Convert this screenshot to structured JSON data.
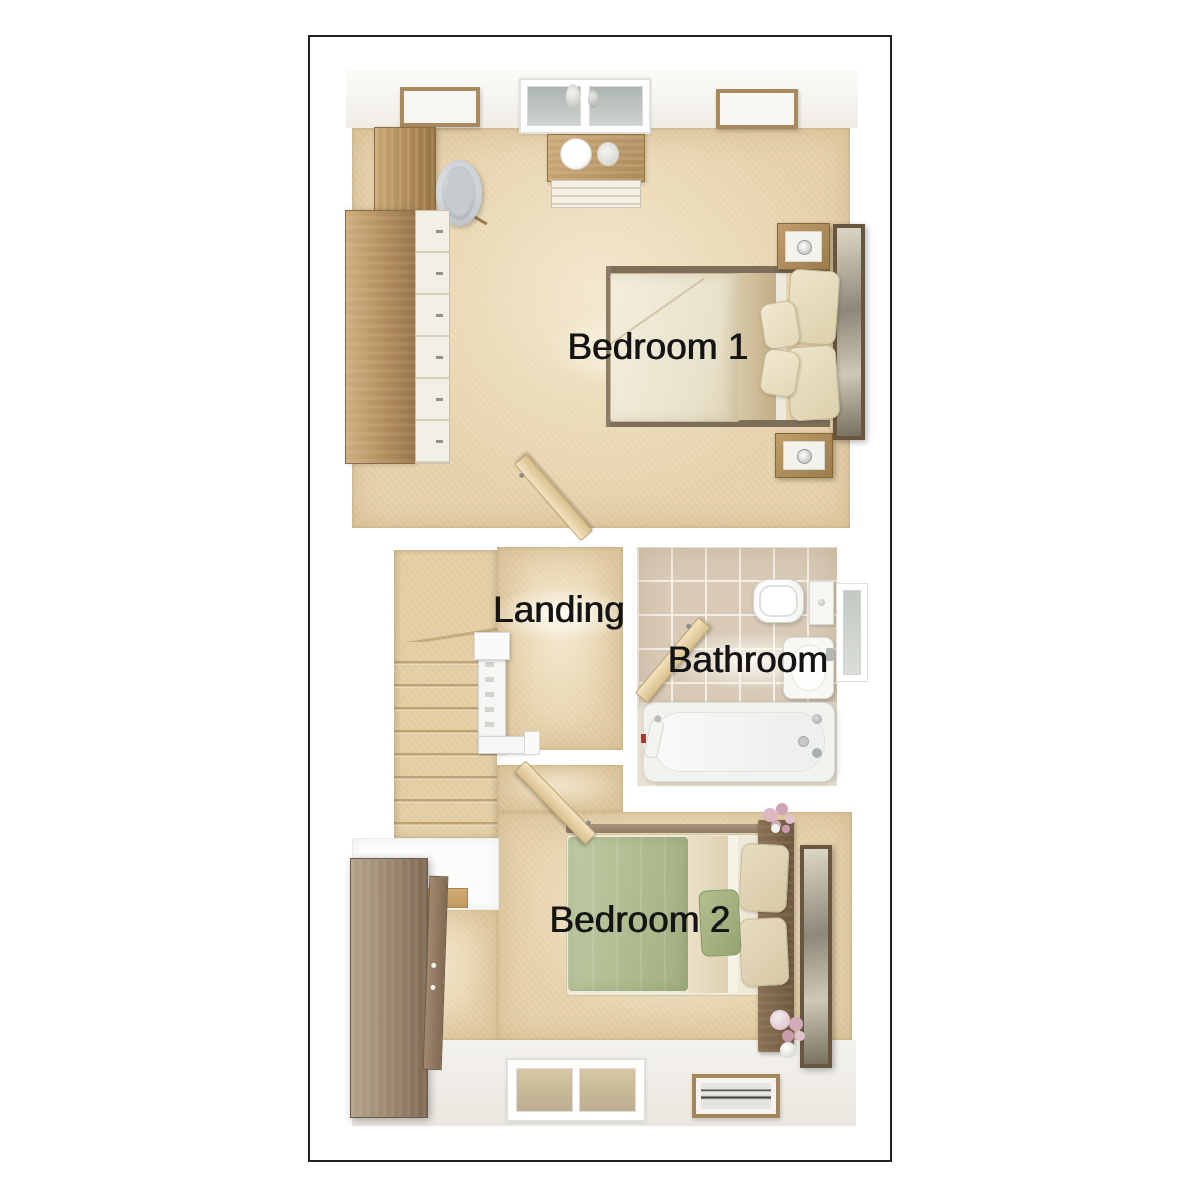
{
  "floorplan": {
    "rooms": [
      {
        "id": "bedroom-1",
        "label": "Bedroom 1",
        "furniture": [
          "double-bed",
          "pillows",
          "nightstand-with-lamp",
          "nightstand-with-lamp",
          "wall-mirror",
          "tall-wardrobe",
          "drawer-unit",
          "dresser-with-plate-and-vase",
          "tub-chair",
          "picture-frame",
          "picture-frame",
          "window",
          "door"
        ]
      },
      {
        "id": "landing",
        "label": "Landing",
        "furniture": [
          "staircase-with-winders",
          "banister",
          "newel-post",
          "handrail"
        ]
      },
      {
        "id": "bathroom",
        "label": "Bathroom",
        "furniture": [
          "toilet",
          "wash-basin",
          "bathtub",
          "shower-handset",
          "window",
          "door"
        ]
      },
      {
        "id": "bedroom-2",
        "label": "Bedroom 2",
        "furniture": [
          "double-bed",
          "green-duvet",
          "pillows",
          "accent-cushion",
          "headboard",
          "wall-mirror",
          "wardrobe",
          "flower-vase",
          "flower-vase",
          "picture-frame",
          "window",
          "door"
        ]
      }
    ],
    "colors": {
      "background": "#ffffff",
      "plan_border": "#212121",
      "wall": "#f7f6f3",
      "carpet": "#e8d4ae",
      "tile_wall": "#d8cab7",
      "bath_floor": "#ebe4d6",
      "wood_light": "#c9a674",
      "wood_mid": "#a8875a",
      "wood_dark": "#6e583d",
      "duvet_cream": "#f2ecda",
      "duvet_green": "#aab78a",
      "fixture_white": "#f6f6f3",
      "label_text": "#141414"
    }
  }
}
